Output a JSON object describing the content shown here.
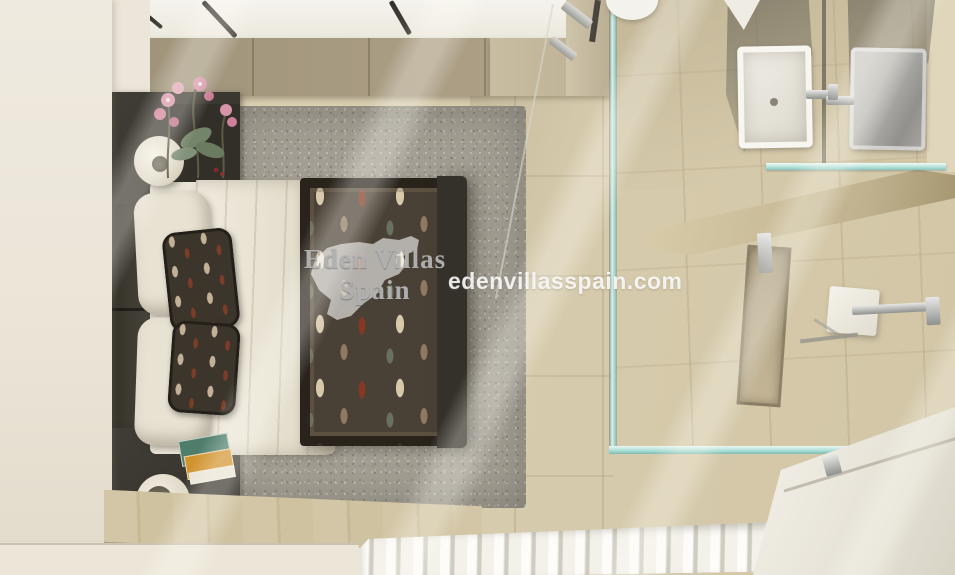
{
  "page": {
    "title": "Top-down 3D render of a bedroom with en-suite bathroom"
  },
  "watermark": {
    "brand_line1": "Eden Villas",
    "brand_line2": "Spain",
    "website": "edenvillasspain.com",
    "map_shape": "spain-silhouette",
    "brand_text_color": "#b2b2b2",
    "website_text_color": "#fafaf8"
  },
  "scene": {
    "view": "top-down interior render",
    "rooms": [
      {
        "name": "bedroom"
      },
      {
        "name": "bathroom"
      }
    ],
    "objects": [
      "double-bed",
      "dark-headboard",
      "cream-pillows",
      "patterned-cushions",
      "white-duvet",
      "patterned-bedspread",
      "grey-shag-rug",
      "nightstand-top",
      "nightstand-bottom",
      "table-lamp-top",
      "table-lamp-bottom",
      "orchid-flowers",
      "magazines",
      "ceiling-light-rails",
      "glass-shower-screen",
      "white-washbasin",
      "steel-washbasin",
      "chrome-faucets",
      "mirror",
      "glass-shelf",
      "vanity-counter",
      "shower-niche",
      "shower-fixture",
      "towel-rail",
      "bathtub",
      "white-radiator",
      "beige-tile-floor",
      "wood-floor-strip",
      "taupe-headboard-wall"
    ],
    "palette": {
      "wall_cream": "#ece7db",
      "wall_taupe": "#a79a81",
      "floor_beige": "#d9ceb2",
      "bed_frame_dark": "#3b3933",
      "pillow_cream": "#e8e2d3",
      "bedspread_brown": "#4a4136",
      "rug_grey": "#a39e93",
      "glass_teal": "#a9dcd4",
      "fixture_white": "#f3f1ea",
      "chrome": "#b5b8b8",
      "orchid_pink": "#d794a8"
    }
  }
}
